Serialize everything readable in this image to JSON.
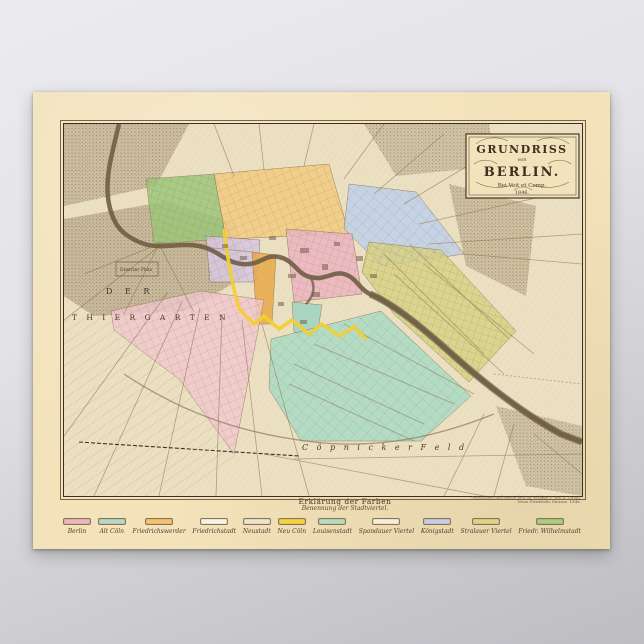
{
  "poster": {
    "cartouche": {
      "title": "GRUNDRISS",
      "von": "von",
      "city": "BERLIN.",
      "publisher": "Bei Veit et Comp.",
      "year": "1846."
    },
    "map": {
      "labels": {
        "der": "D E R",
        "thiergarten": "T H I E R G A R T E N",
        "coepnicker_feld": "C ö p n i c k e r   F e l d",
        "exercier_platz": "Exercier Platz"
      },
      "river_color": "#6f5e45",
      "districts": [
        {
          "name": "park-green",
          "color": "#9dc77b"
        },
        {
          "name": "spandauer-viertel",
          "color": "#f3cd85"
        },
        {
          "name": "koenigstadt",
          "color": "#c2d2e8"
        },
        {
          "name": "berlin",
          "color": "#ecb8c2"
        },
        {
          "name": "friedrich-wilhelmstadt",
          "color": "#d8c8e0"
        },
        {
          "name": "friedrichswerder",
          "color": "#e9ad4f"
        },
        {
          "name": "alt-coeln",
          "color": "#a3d5c1"
        },
        {
          "name": "louisenstadt",
          "color": "#abdcc6"
        },
        {
          "name": "stralauer-viertel",
          "color": "#d7d287"
        },
        {
          "name": "friedrichstadt",
          "color": "#f2c8d0"
        },
        {
          "name": "stadtmauer-gelb",
          "color": "#f2cf35"
        }
      ]
    },
    "legend": {
      "heading": "Erklärung der Farben",
      "subheading": "Benennung der Stadtviertel.",
      "imprint_line1": "Gezeichnet und gestochen im Verlage v. Veit u. Comp.",
      "imprint_line2": "Neue Friedrichs Strasse. 1846.",
      "items": [
        {
          "label": "Berlin",
          "color": "#e9b7bf"
        },
        {
          "label": "Alt Cöln",
          "color": "#b9d6c6"
        },
        {
          "label": "Friedrichswerder",
          "color": "#f2c470"
        },
        {
          "label": "Friedrichstadt",
          "color": "#f7f3e6"
        },
        {
          "label": "Neustadt",
          "color": "#e9e4d0"
        },
        {
          "label": "Neu Cöln",
          "color": "#f2d341"
        },
        {
          "label": "Louisenstadt",
          "color": "#b5dcc0"
        },
        {
          "label": "Spandauer Viertel",
          "color": "#f4eed8"
        },
        {
          "label": "Königstadt",
          "color": "#c5cee2"
        },
        {
          "label": "Stralauer Viertel",
          "color": "#d9d489"
        },
        {
          "label": "Friedr. Wilhelmstadt",
          "color": "#a8cc82"
        }
      ]
    }
  }
}
